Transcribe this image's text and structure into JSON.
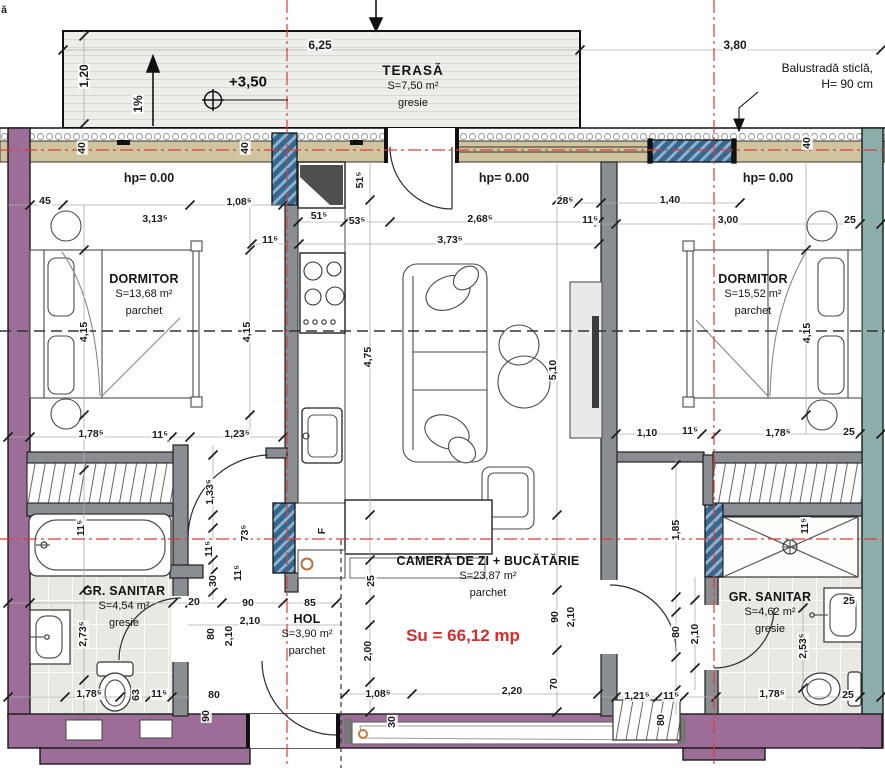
{
  "plan": {
    "terrace": {
      "name": "TERASĂ",
      "area": "S=7,50 m²",
      "finish": "gresie",
      "elevation": "+3,50",
      "slope": "1%"
    },
    "annotations": {
      "balustrade_line1": "Balustradă sticlă,",
      "balustrade_line2": "H= 90 cm",
      "total_area": "Su = 66,12 mp",
      "fridge": "F",
      "corner_fragment": "ă"
    },
    "rooms": [
      {
        "name": "DORMITOR",
        "area": "S=13,68 m²",
        "finish": "parchet"
      },
      {
        "name": "CAMERĂ DE ZI + BUCĂTĂRIE",
        "area": "S=23,87 m²",
        "finish": "parchet"
      },
      {
        "name": "DORMITOR",
        "area": "S=15,52 m²",
        "finish": "parchet"
      },
      {
        "name": "HOL",
        "area": "S=3,90 m²",
        "finish": "parchet"
      },
      {
        "name": "GR. SANITAR",
        "area": "S=4,54 m²",
        "finish": "gresie"
      },
      {
        "name": "GR. SANITAR",
        "area": "S=4,62 m²",
        "finish": "gresie"
      }
    ],
    "dimensions": [
      {
        "t": "6,25",
        "x": 320,
        "y": 45,
        "c": "lg"
      },
      {
        "t": "3,80",
        "x": 735,
        "y": 45,
        "c": "lg"
      },
      {
        "t": "1,20",
        "x": 84,
        "y": 76,
        "r": 1,
        "c": "lg"
      },
      {
        "t": "1%",
        "x": 138,
        "y": 104,
        "r": 1,
        "c": "lg"
      },
      {
        "t": "40",
        "x": 82,
        "y": 148,
        "r": 1
      },
      {
        "t": "40",
        "x": 245,
        "y": 148,
        "r": 1
      },
      {
        "t": "40",
        "x": 807,
        "y": 143,
        "r": 1
      },
      {
        "t": "hp= 0.00",
        "x": 149,
        "y": 178,
        "c": "hp"
      },
      {
        "t": "hp= 0.00",
        "x": 504,
        "y": 178,
        "c": "hp"
      },
      {
        "t": "hp= 0.00",
        "x": 768,
        "y": 178,
        "c": "hp"
      },
      {
        "t": "45",
        "x": 45,
        "y": 201
      },
      {
        "t": "3,13⁵",
        "x": 155,
        "y": 219
      },
      {
        "t": "1,08⁵",
        "x": 239,
        "y": 202
      },
      {
        "t": "51⁵",
        "x": 360,
        "y": 180,
        "r": 1
      },
      {
        "t": "51⁵",
        "x": 319,
        "y": 216
      },
      {
        "t": "53⁵",
        "x": 357,
        "y": 221
      },
      {
        "t": "2,68⁵",
        "x": 480,
        "y": 219
      },
      {
        "t": "28⁵",
        "x": 565,
        "y": 201
      },
      {
        "t": "11⁵",
        "x": 590,
        "y": 220
      },
      {
        "t": "1,40",
        "x": 670,
        "y": 200
      },
      {
        "t": "3,00",
        "x": 728,
        "y": 220
      },
      {
        "t": "25",
        "x": 850,
        "y": 220
      },
      {
        "t": "11⁵",
        "x": 270,
        "y": 240
      },
      {
        "t": "3,73⁵",
        "x": 450,
        "y": 240
      },
      {
        "t": "4,15",
        "x": 84,
        "y": 332,
        "r": 1
      },
      {
        "t": "4,15",
        "x": 247,
        "y": 332,
        "r": 1
      },
      {
        "t": "4,15",
        "x": 807,
        "y": 333,
        "r": 1
      },
      {
        "t": "4,75",
        "x": 368,
        "y": 357,
        "r": 1
      },
      {
        "t": "5,10",
        "x": 553,
        "y": 370,
        "r": 1
      },
      {
        "t": "1,78⁵",
        "x": 91,
        "y": 434
      },
      {
        "t": "11⁵",
        "x": 160,
        "y": 435
      },
      {
        "t": "1,23⁵",
        "x": 237,
        "y": 434
      },
      {
        "t": "1,10",
        "x": 647,
        "y": 433
      },
      {
        "t": "11⁵",
        "x": 690,
        "y": 431
      },
      {
        "t": "1,78⁵",
        "x": 778,
        "y": 433
      },
      {
        "t": "25",
        "x": 849,
        "y": 432
      },
      {
        "t": "11⁵",
        "x": 81,
        "y": 528,
        "r": 1
      },
      {
        "t": "1,33⁵",
        "x": 210,
        "y": 492,
        "r": 1
      },
      {
        "t": "73⁵",
        "x": 245,
        "y": 533,
        "r": 1
      },
      {
        "t": "11⁵",
        "x": 209,
        "y": 549,
        "r": 1
      },
      {
        "t": "11⁵",
        "x": 238,
        "y": 573,
        "r": 1
      },
      {
        "t": "30",
        "x": 213,
        "y": 581,
        "r": 1
      },
      {
        "t": "20",
        "x": 194,
        "y": 602
      },
      {
        "t": "90",
        "x": 248,
        "y": 603
      },
      {
        "t": "85",
        "x": 310,
        "y": 603
      },
      {
        "t": "2,10",
        "x": 250,
        "y": 621
      },
      {
        "t": "80",
        "x": 211,
        "y": 634,
        "r": 1
      },
      {
        "t": "2,10",
        "x": 229,
        "y": 636,
        "r": 1
      },
      {
        "t": "2,73⁵",
        "x": 83,
        "y": 634,
        "r": 1
      },
      {
        "t": "F",
        "x": 322,
        "y": 531,
        "r": 1
      },
      {
        "t": "25",
        "x": 371,
        "y": 581,
        "r": 1
      },
      {
        "t": "2,00",
        "x": 368,
        "y": 651,
        "r": 1
      },
      {
        "t": "90",
        "x": 555,
        "y": 617,
        "r": 1
      },
      {
        "t": "2,10",
        "x": 571,
        "y": 617,
        "r": 1
      },
      {
        "t": "70",
        "x": 554,
        "y": 684,
        "r": 1
      },
      {
        "t": "1,85",
        "x": 676,
        "y": 530,
        "r": 1
      },
      {
        "t": "11⁵",
        "x": 805,
        "y": 526,
        "r": 1
      },
      {
        "t": "25",
        "x": 849,
        "y": 601
      },
      {
        "t": "2,53⁵",
        "x": 803,
        "y": 646,
        "r": 1
      },
      {
        "t": "80",
        "x": 676,
        "y": 632,
        "r": 1
      },
      {
        "t": "2,10",
        "x": 695,
        "y": 634,
        "r": 1
      },
      {
        "t": "1,78⁵",
        "x": 89,
        "y": 694
      },
      {
        "t": "63",
        "x": 136,
        "y": 695,
        "r": 1
      },
      {
        "t": "11⁵",
        "x": 159,
        "y": 694
      },
      {
        "t": "80",
        "x": 214,
        "y": 695
      },
      {
        "t": "90",
        "x": 206,
        "y": 716,
        "r": 1
      },
      {
        "t": "1,08⁵",
        "x": 378,
        "y": 694
      },
      {
        "t": "30",
        "x": 392,
        "y": 722,
        "r": 1
      },
      {
        "t": "2,20",
        "x": 512,
        "y": 691
      },
      {
        "t": "80",
        "x": 661,
        "y": 720,
        "r": 1
      },
      {
        "t": "1,21⁵",
        "x": 637,
        "y": 696
      },
      {
        "t": "11⁵",
        "x": 671,
        "y": 696
      },
      {
        "t": "1,78⁵",
        "x": 772,
        "y": 694
      },
      {
        "t": "25",
        "x": 848,
        "y": 695
      },
      {
        "t": "ă",
        "x": 4,
        "y": 10
      }
    ]
  },
  "colors": {
    "wall_purple": "#9c6d97",
    "wall_teal": "#8cafab",
    "wall_tan": "#cfc49e",
    "window_blue": "#36678f",
    "axis_red": "#e03a3a",
    "total_area_red": "#d92b2b"
  }
}
